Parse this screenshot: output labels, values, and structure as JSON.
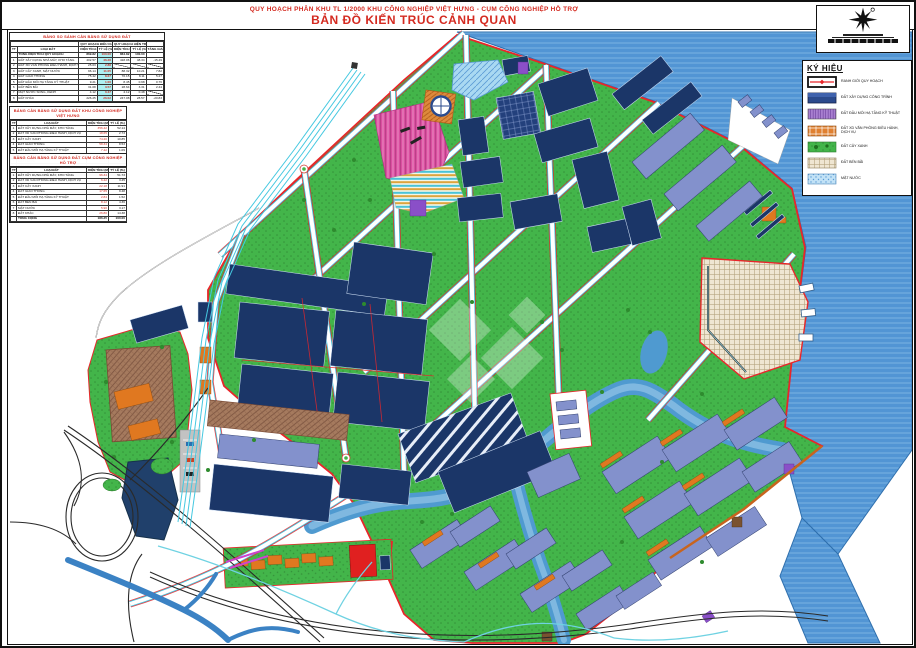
{
  "header": {
    "line1": "QUY HOẠCH PHÂN KHU TL 1/2000 KHU CÔNG NGHIỆP VIỆT HƯNG - CỤM CÔNG NGHIỆP HỖ TRỢ",
    "line2": "BẢN ĐỒ KIẾN TRÚC CẢNH QUAN"
  },
  "legend": {
    "title": "KÝ HIỆU",
    "items": [
      {
        "key": "boundary",
        "label": "RANH GIỚI QUY HOẠCH"
      },
      {
        "key": "building",
        "label": "ĐẤT XÂY DỰNG CÔNG TRÌNH"
      },
      {
        "key": "infra",
        "label": "ĐẤT ĐẦU MỐI HẠ TẦNG KỸ THUẬT"
      },
      {
        "key": "office",
        "label": "ĐẤT XD VĂN PHÒNG ĐIỀU HÀNH, DỊCH VỤ"
      },
      {
        "key": "green",
        "label": "ĐẤT CÂY XANH"
      },
      {
        "key": "yard",
        "label": "ĐẤT BẾN BÃI"
      },
      {
        "key": "water",
        "label": "MẶT NƯỚC"
      }
    ]
  },
  "tables": {
    "t1": {
      "title": "BẢNG SO SÁNH CÂN BẰNG SỬ DỤNG ĐẤT",
      "group_headers": [
        "QUY HOẠCH ĐIỀU CHỈNH",
        "QUY HOẠCH HIỆN TRẠNG"
      ],
      "columns": [
        "TT",
        "LOẠI ĐẤT",
        "DIỆN TÍCH (M2)",
        "TỶ LỆ (%)",
        "DIỆN TÍCH (M2)",
        "TỶ LỆ (%)",
        "TĂNG GIẢM"
      ],
      "total_row": [
        "",
        "TỔNG DIỆN TÍCH QUY HOẠCH",
        "869.82",
        "100.00",
        "864.82",
        "100.00",
        ""
      ],
      "rows": [
        [
          "1",
          "ĐẤT XÂY DỰNG NHÀ MÁY, KHO TÀNG",
          "402.57",
          "46.28",
          "418.06",
          "48.34",
          "-15.49"
        ],
        [
          "2",
          "ĐẤT XD VĂN PHÒNG ĐIỀU HÀNH, DỊCH VỤ",
          "25.03",
          "2.88",
          "~",
          "~",
          "~"
        ],
        [
          "3",
          "ĐẤT CÂY XANH, MẶT NƯỚC",
          "96.14",
          "11.05",
          "88.32",
          "10.21",
          "7.82"
        ],
        [
          "4",
          "ĐẤT GIAO THÔNG",
          "75.42",
          "8.67",
          "70.15",
          "8.11",
          "5.27"
        ],
        [
          "5",
          "ĐẤT ĐẦU MỐI HẠ TẦNG KỸ THUẬT",
          "9.21",
          "1.06",
          "8.45",
          "0.98",
          "0.76"
        ],
        [
          "6",
          "ĐẤT BẾN BÃI",
          "31.08",
          "3.57",
          "28.64",
          "3.31",
          "2.44"
        ],
        [
          "7",
          "MẶT NƯỚC SÔNG, KÊNH",
          "4.12",
          "0.47",
          "4.12",
          "0.48",
          "~"
        ],
        [
          "8",
          "ĐẤT KHÁC",
          "226.25",
          "26.02",
          "247.08",
          "28.57",
          "-20.83"
        ]
      ]
    },
    "t2": {
      "title": "BẢNG CÂN BẰNG SỬ DỤNG ĐẤT KHU CÔNG NGHIỆP VIỆT HƯNG",
      "columns": [
        "TT",
        "LOẠI ĐẤT",
        "DIỆN TÍCH (M2)",
        "TỶ LỆ (%)"
      ],
      "rows": [
        [
          "1",
          "ĐẤT XÂY DỰNG NHÀ MÁY, KHO TÀNG",
          "356.42",
          "52.14"
        ],
        [
          "2",
          "ĐẤT XD VĂN PHÒNG ĐIỀU HÀNH, DỊCH VỤ",
          "18.65",
          "2.73"
        ],
        [
          "3",
          "ĐẤT CÂY XANH",
          "74.20",
          "10.85"
        ],
        [
          "4",
          "ĐẤT GIAO THÔNG",
          "58.34",
          "8.53"
        ],
        [
          "5",
          "ĐẤT ĐẦU MỐI HẠ TẦNG KỸ THUẬT",
          "7.42",
          "1.09"
        ],
        [
          "6",
          "ĐẤT BẾN BÃI",
          "31.08",
          "4.55"
        ],
        [
          "7",
          "MẶT NƯỚC",
          "20.16",
          "2.95"
        ],
        [
          "8",
          "ĐẤT KHÁC",
          "117.30",
          "17.16"
        ]
      ],
      "total_row": [
        "",
        "TỔNG CỘNG",
        "683.57",
        "100.00"
      ]
    },
    "t3": {
      "title": "BẢNG CÂN BẰNG SỬ DỤNG ĐẤT CỤM CÔNG NGHIỆP HỖ TRỢ",
      "columns": [
        "TT",
        "LOẠI ĐẤT",
        "DIỆN TÍCH (M2)",
        "TỶ LỆ (%)"
      ],
      "rows": [
        [
          "1",
          "ĐẤT XÂY DỰNG NHÀ MÁY, KHO TÀNG",
          "96.34",
          "51.73"
        ],
        [
          "2",
          "ĐẤT XD VĂN PHÒNG ĐIỀU HÀNH, DỊCH VỤ",
          "6.42",
          "3.45"
        ],
        [
          "3",
          "ĐẤT CÂY XANH",
          "22.18",
          "11.91"
        ],
        [
          "4",
          "ĐẤT GIAO THÔNG",
          "17.65",
          "9.48"
        ],
        [
          "5",
          "ĐẤT ĐẦU MỐI HẠ TẦNG KỸ THUẬT",
          "2.84",
          "1.52"
        ],
        [
          "6",
          "ĐẤT BẾN BÃI",
          "8.12",
          "4.36"
        ],
        [
          "7",
          "MẶT NƯỚC",
          "5.90",
          "3.17"
        ],
        [
          "8",
          "ĐẤT KHÁC",
          "26.80",
          "14.38"
        ]
      ],
      "total_row": [
        "",
        "TỔNG CỘNG",
        "186.25",
        "100.00"
      ]
    }
  },
  "colors": {
    "red": "#d42a20",
    "boundary": "#e8262a",
    "green": "#43b54a",
    "green_dark": "#2f8f2f",
    "navy": "#1b3668",
    "periwinkle": "#8391cc",
    "water": "#5295d4",
    "water_light": "#a9d9f2",
    "cyan": "#3fc8e0",
    "orange": "#e07820",
    "orange_dark": "#c8641e",
    "tan": "#efe6d2",
    "brown": "#a57a5e",
    "magenta": "#d94fa0",
    "purple": "#8a4fc8",
    "black": "#111111"
  }
}
